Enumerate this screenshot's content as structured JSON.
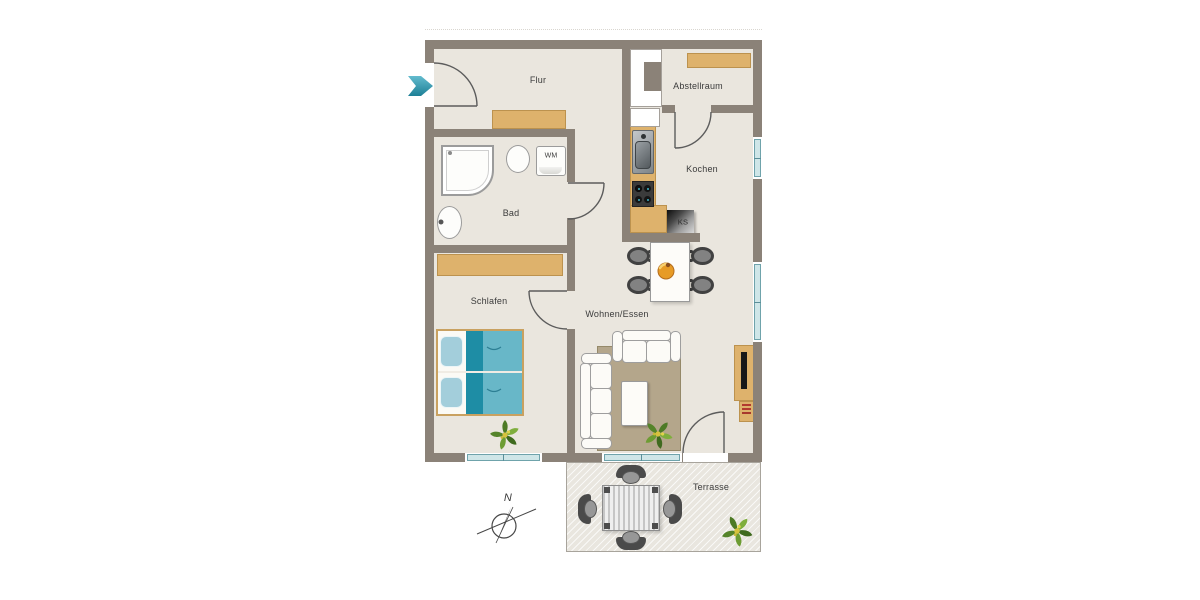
{
  "plan": {
    "rooms": {
      "flur": {
        "label": "Flur"
      },
      "abstellraum": {
        "label": "Abstellraum"
      },
      "kochen": {
        "label": "Kochen"
      },
      "bad": {
        "label": "Bad"
      },
      "schlafen": {
        "label": "Schlafen"
      },
      "wohnen_essen": {
        "label": "Wohnen/Essen"
      },
      "terrasse": {
        "label": "Terrasse"
      }
    },
    "appliances": {
      "washing_machine": {
        "label": "WM"
      },
      "fridge": {
        "label": "KS"
      }
    },
    "compass": {
      "north": "N"
    },
    "icons": [
      "entry-arrow-icon",
      "compass-icon",
      "plant-icon",
      "shower-icon",
      "toilet-icon",
      "bath-sink-icon",
      "kitchen-sink-icon",
      "stove-icon",
      "fridge-icon",
      "bed-icon",
      "sofa-icon",
      "coffee-table-icon",
      "dining-table-icon",
      "fruit-bowl-icon",
      "tv-lowboard-icon",
      "terrace-table-icon",
      "terrace-chair-icon",
      "window-icon",
      "door-arc-icon"
    ],
    "colors": {
      "wall": "#8b8278",
      "floor": "#eae6de",
      "furniture_wood": "#deb26c",
      "accent_teal": "#2b93a9",
      "bed_teal_dark": "#1e8da5",
      "bed_teal_light": "#68b7c8",
      "window_glass": "#cfe6e8",
      "rug_brown": "#b4a68b",
      "terrace_floor": "#e9e6df",
      "chair_dark": "#414141"
    }
  }
}
